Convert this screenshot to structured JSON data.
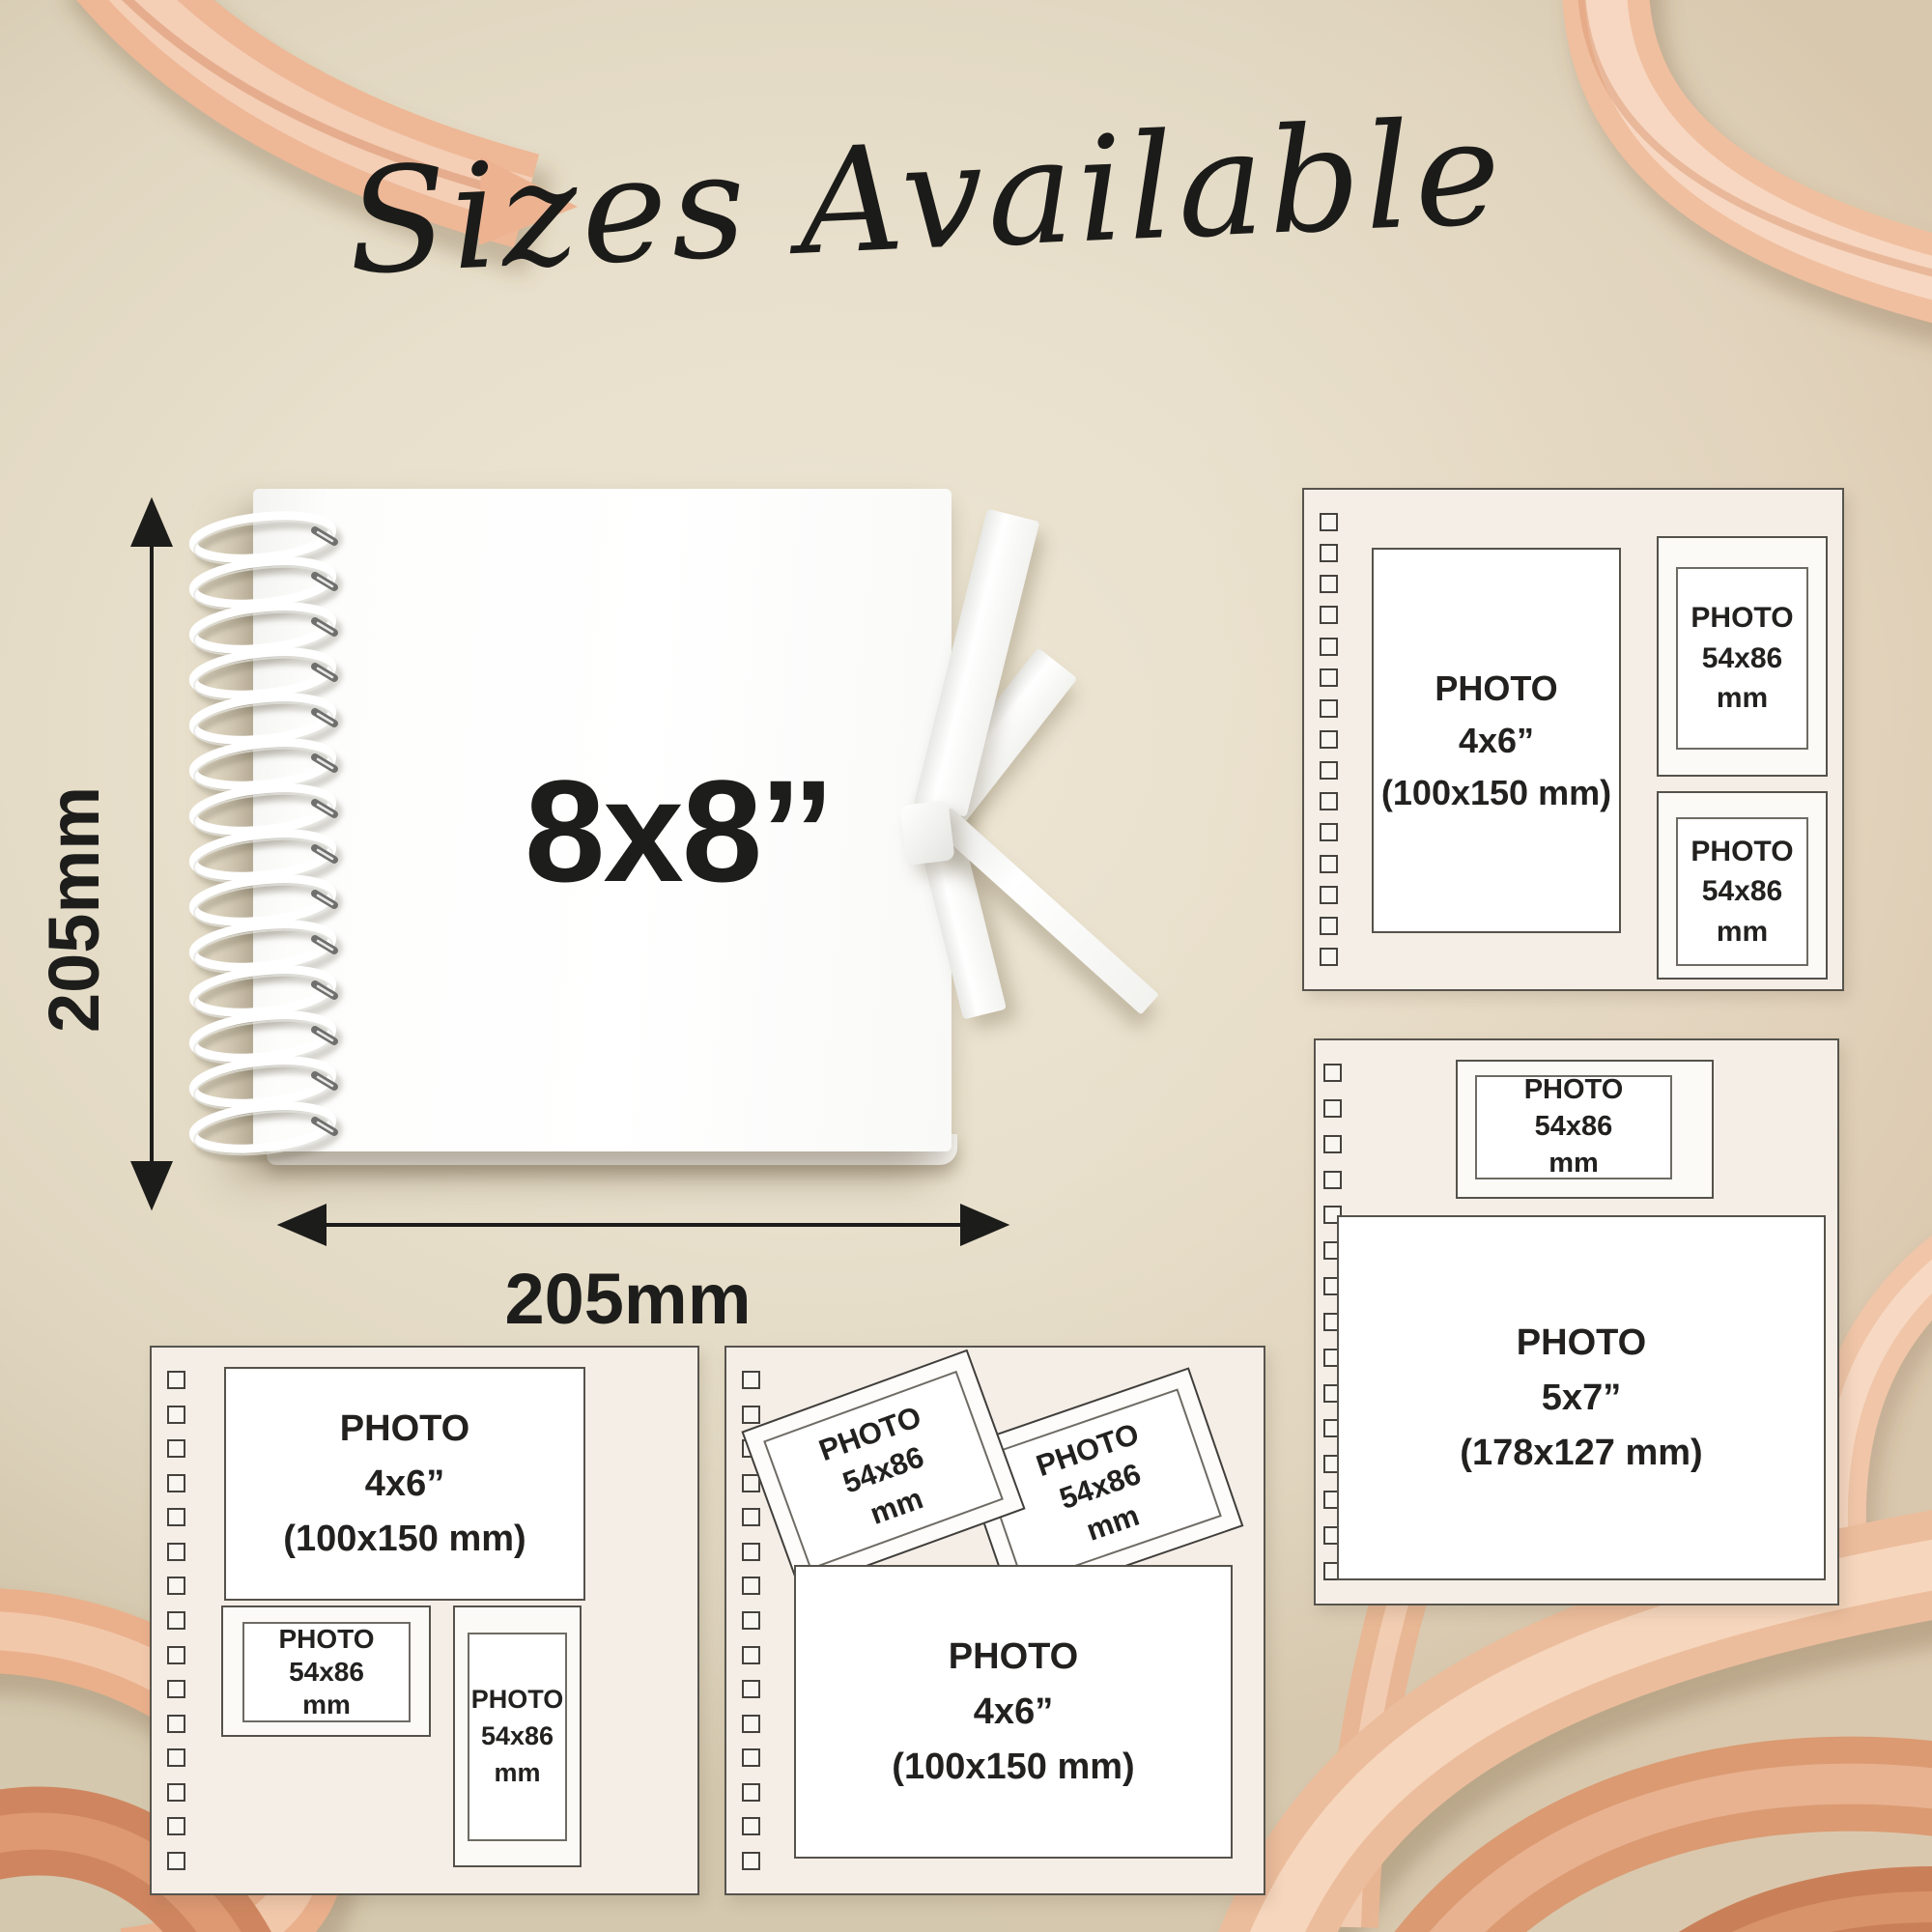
{
  "title": "Sizes Available",
  "book": {
    "size_label": "8x8’’",
    "width_label": "205mm",
    "height_label": "205mm"
  },
  "photo_labels": {
    "photo_4x6": [
      "PHOTO",
      "4x6”",
      "(100x150 mm)"
    ],
    "photo_5x7": [
      "PHOTO",
      "5x7”",
      "(178x127 mm)"
    ],
    "photo_card": [
      "PHOTO",
      "54x86",
      "mm"
    ]
  },
  "colors": {
    "background_beige": "#e8e0cc",
    "page_cream": "#f5eee7",
    "ribbon_peach": "#eab28d",
    "text_dark": "#222120"
  }
}
